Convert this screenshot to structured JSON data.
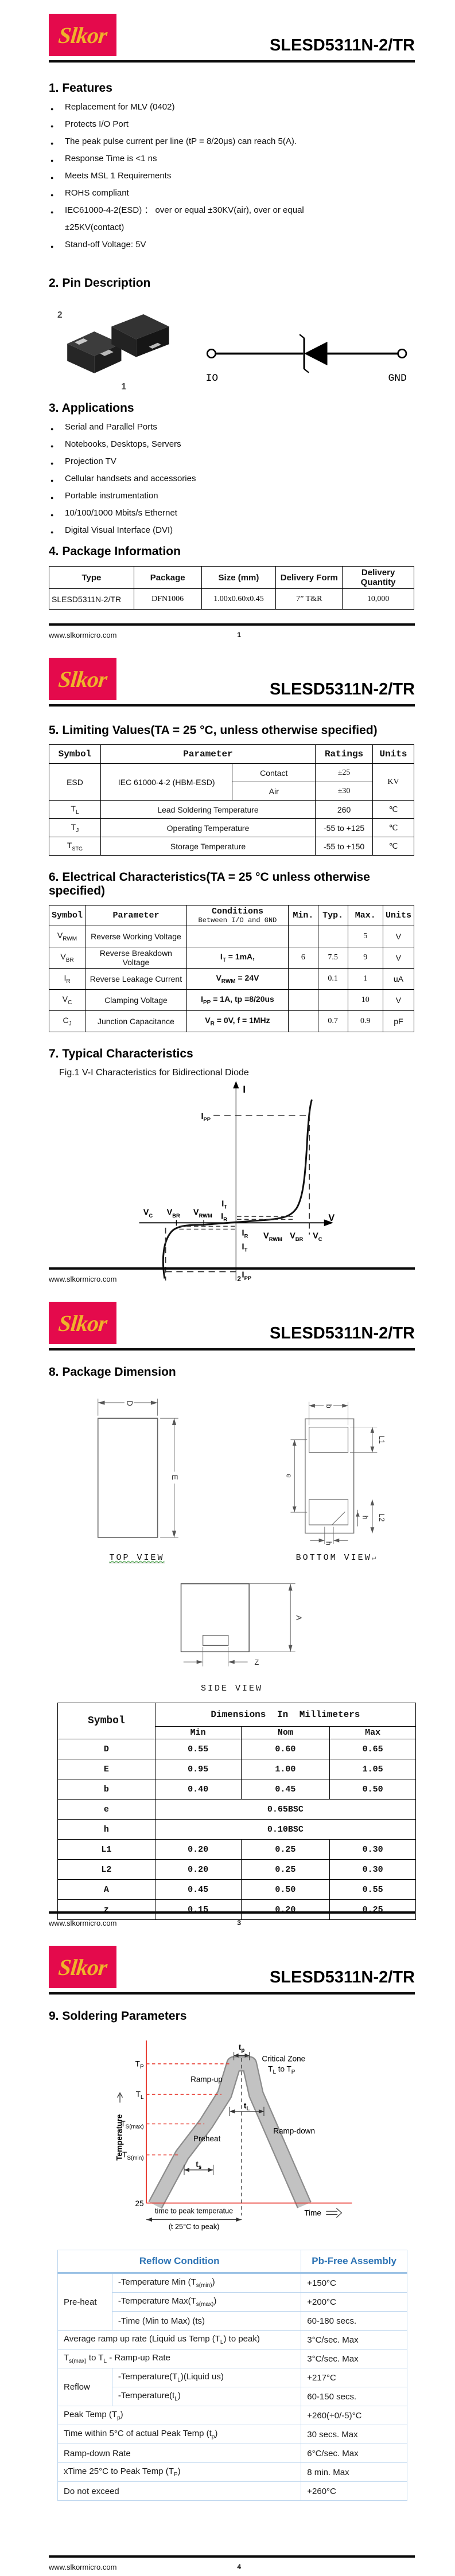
{
  "brand": {
    "logo_text": "Slkor",
    "title": "SLESD5311N-2/TR",
    "website": "www.slkormicro.com"
  },
  "footer": {
    "p1": "1",
    "p2": "2",
    "p3": "3",
    "p4": "4"
  },
  "features": {
    "heading": "1. Features",
    "items": [
      "Replacement for MLV (0402)",
      "Protects I/O Port",
      "The peak pulse current per line (tP = 8/20μs) can reach 5(A).",
      "Response Time is <1 ns",
      "Meets MSL 1 Requirements",
      "ROHS compliant",
      "IEC61000-4-2(ESD) ： over or equal ±30KV(air), over or equal"
    ],
    "cont": "±25KV(contact)",
    "last": "Stand-off Voltage: 5V"
  },
  "pin": {
    "heading": "2. Pin Description",
    "pin2": "2",
    "pin1": "1",
    "io": "IO",
    "gnd": "GND"
  },
  "apps": {
    "heading": "3. Applications",
    "items": [
      "Serial and Parallel Ports",
      "Notebooks, Desktops, Servers",
      "Projection TV",
      "Cellular handsets and accessories",
      "Portable instrumentation",
      "10/100/1000 Mbits/s Ethernet",
      "Digital Visual Interface (DVI)"
    ]
  },
  "pkg": {
    "heading": "4. Package Information",
    "headers": [
      "Type",
      "Package",
      "Size (mm)",
      "Delivery Form",
      "Delivery Quantity"
    ],
    "row": [
      "SLESD5311N-2/TR",
      "DFN1006",
      "1.00x0.60x0.45",
      "7” T&R",
      "10,000"
    ]
  },
  "limiting": {
    "heading": "5. Limiting Values(TA = 25 °C, unless otherwise specified)",
    "h": [
      "Symbol",
      "Parameter",
      "Ratings",
      "Units"
    ],
    "esd": {
      "symbol": "ESD",
      "param": "IEC 61000-4-2 (HBM-ESD)",
      "contact": "Contact",
      "contact_v": "±25",
      "air": "Air",
      "air_v": "±30",
      "units": "KV"
    },
    "rows": [
      {
        "m": "T",
        "s": "L",
        "param": "Lead Soldering Temperature",
        "rating": "260",
        "units": "℃"
      },
      {
        "m": "T",
        "s": "J",
        "param": "Operating Temperature",
        "rating": "-55 to +125",
        "units": "℃"
      },
      {
        "m": "T",
        "s": "STG",
        "param": "Storage Temperature",
        "rating": "-55 to +150",
        "units": "℃"
      }
    ]
  },
  "electrical": {
    "heading": "6. Electrical Characteristics(TA = 25 °C unless otherwise specified)",
    "h": [
      "Symbol",
      "Parameter",
      "Conditions",
      "Min.",
      "Typ.",
      "Max.",
      "Units"
    ],
    "cond_sub": "Between I/O and GND",
    "rows": [
      {
        "m": "V",
        "s": "RWM",
        "param": "Reverse Working Voltage",
        "c1": "",
        "c2": "",
        "c3": "",
        "min": "",
        "typ": "",
        "max": "5",
        "units": "V"
      },
      {
        "m": "V",
        "s": "BR",
        "param": "Reverse Breakdown Voltage",
        "c1": "I",
        "c2": "T",
        "c3": " = 1mA,",
        "min": "6",
        "typ": "7.5",
        "max": "9",
        "units": "V"
      },
      {
        "m": "I",
        "s": "R",
        "param": "Reverse Leakage Current",
        "c1": "V",
        "c2": "RWM",
        "c3": " = 24V",
        "min": "",
        "typ": "0.1",
        "max": "1",
        "units": "uA"
      },
      {
        "m": "V",
        "s": "C",
        "param": "Clamping Voltage",
        "c1": "I",
        "c2": "PP",
        "c3": " = 1A, tp =8/20us",
        "min": "",
        "typ": "",
        "max": "10",
        "units": "V"
      },
      {
        "m": "C",
        "s": "J",
        "param": "Junction Capacitance",
        "c1": "V",
        "c2": "R",
        "c3": " = 0V, f = 1MHz",
        "min": "",
        "typ": "0.7",
        "max": "0.9",
        "units": "pF"
      }
    ]
  },
  "typical": {
    "heading": "7. Typical Characteristics",
    "caption": "Fig.1 V-I Characteristics for Bidirectional Diode",
    "vi": {
      "axis_i": "I",
      "axis_v": "V",
      "ipp": {
        "m": "I",
        "s": "PP"
      },
      "it": {
        "m": "I",
        "s": "T"
      },
      "ir": {
        "m": "I",
        "s": "R"
      },
      "vc": {
        "m": "V",
        "s": "C"
      },
      "vbr": {
        "m": "V",
        "s": "BR"
      },
      "vrwm": {
        "m": "V",
        "s": "RWM"
      }
    }
  },
  "dim": {
    "heading": "8. Package Dimension",
    "views": {
      "top": "TOP VIEW",
      "bottom": "BOTTOM VIEW",
      "side": "SIDE VIEW",
      "ret": "↵"
    },
    "labels": {
      "D": "D",
      "E": "E",
      "b": "b",
      "L1": "L1",
      "e": "e",
      "h": "h",
      "L2": "L2",
      "A": "A",
      "Z": "Z"
    },
    "table": {
      "symbol": "Symbol",
      "dims": "Dimensions In Millimeters",
      "sub": [
        "Min",
        "Nom",
        "Max"
      ],
      "rows": [
        {
          "sym": "D",
          "min": "0.55",
          "nom": "0.60",
          "max": "0.65"
        },
        {
          "sym": "E",
          "min": "0.95",
          "nom": "1.00",
          "max": "1.05"
        },
        {
          "sym": "b",
          "min": "0.40",
          "nom": "0.45",
          "max": "0.50"
        },
        {
          "sym": "e",
          "span": "0.65BSC"
        },
        {
          "sym": "h",
          "span": "0.10BSC"
        },
        {
          "sym": "L1",
          "min": "0.20",
          "nom": "0.25",
          "max": "0.30"
        },
        {
          "sym": "L2",
          "min": "0.20",
          "nom": "0.25",
          "max": "0.30"
        },
        {
          "sym": "A",
          "min": "0.45",
          "nom": "0.50",
          "max": "0.55"
        },
        {
          "sym": "z",
          "min": "0.15",
          "nom": "0.20",
          "max": "0.25"
        }
      ]
    }
  },
  "solder": {
    "heading": "9. Soldering Parameters",
    "profile": {
      "tp": {
        "m": "t",
        "s": "p"
      },
      "Tp": {
        "m": "T",
        "s": "P"
      },
      "Tl": {
        "m": "T",
        "s": "L"
      },
      "Tsmax": {
        "m": "T",
        "s": "S(max)"
      },
      "Tsmin": {
        "m": "T",
        "s": "S(min)"
      },
      "deg25": "25",
      "temperature": "Temperature",
      "time": "Time",
      "rampup": "Ramp-up",
      "rampdown": "Ramp-down",
      "preheat": "Preheat",
      "critical": "Critical Zone",
      "crit2": {
        "a": "T",
        "b": "L",
        "c": " to T",
        "d": "P"
      },
      "tl": {
        "m": "t",
        "s": "L"
      },
      "ts": {
        "m": "t",
        "s": "s"
      },
      "ttp": "time to peak temperatue",
      "ttp2": "(t 25°C to peak)"
    },
    "table": {
      "h1": "Reflow Condition",
      "h2": "Pb-Free Assembly",
      "preheat_label": "Pre-heat",
      "reflow_label": "Reflow",
      "rows": {
        "r1": {
          "parts": [
            "-Temperature Min (T",
            "s(min)",
            ")"
          ],
          "v": "+150°C"
        },
        "r2": {
          "parts": [
            "-Temperature Max(T",
            "s(max)",
            ")"
          ],
          "v": "+200°C"
        },
        "r3": {
          "parts": [
            "-Time (Min to Max) (ts)"
          ],
          "v": "60-180 secs."
        },
        "r4": {
          "parts": [
            "Average ramp up rate (Liquid us Temp (T",
            "L",
            ") to peak)"
          ],
          "v": "3°C/sec. Max"
        },
        "r5": {
          "parts": [
            "T",
            "s(max)",
            " to T",
            "L",
            " - Ramp-up Rate"
          ],
          "v": "3°C/sec. Max"
        },
        "r6": {
          "parts": [
            "-Temperature(T",
            "L",
            ")(Liquid us)"
          ],
          "v": "+217°C"
        },
        "r7": {
          "parts": [
            "-Temperature(t",
            "L",
            ")"
          ],
          "v": "60-150 secs."
        },
        "r8": {
          "parts": [
            "Peak Temp (T",
            "p",
            ")"
          ],
          "v": "+260(+0/-5)°C"
        },
        "r9": {
          "parts": [
            "Time within 5°C of actual Peak Temp (t",
            "p",
            ")"
          ],
          "v": "30 secs. Max"
        },
        "r10": {
          "parts": [
            "Ramp-down Rate"
          ],
          "v": "6°C/sec. Max"
        },
        "r11": {
          "parts": [
            "xTime 25°C to Peak Temp (T",
            "P",
            ")"
          ],
          "v": "8 min. Max"
        },
        "r12": {
          "parts": [
            "Do not exceed"
          ],
          "v": "+260°C"
        }
      }
    }
  }
}
